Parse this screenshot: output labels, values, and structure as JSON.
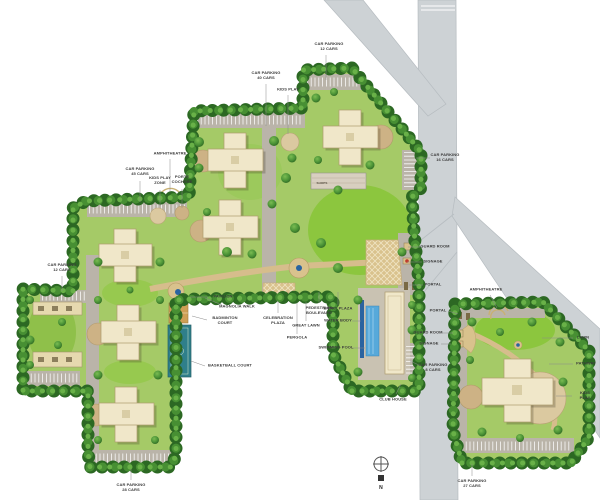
{
  "plan": {
    "title": "residential township master plan",
    "compass_north": "N",
    "labels": {
      "car_parking_12_top": "CAR PARKING\n12 CARS",
      "car_parking_40": "CAR PARKING\n40 CARS",
      "kids_play_top": "KIDS PLAY",
      "car_parking_16": "CAR PARKING\n16 CARS",
      "amphitheatre_left": "AMPHITHEATRE",
      "car_parking_45": "CAR PARKING\n45 CARS",
      "kids_play_zone": "KIDS PLAY\nZONE",
      "porte_cochere": "PORTE\nCOCHERE",
      "car_parking_12_left": "CAR PARKING\n12 CARS",
      "pavilion": "PAVILION",
      "magnolia_walk": "MAGNOLIA WALK",
      "badminton_court": "BADMINTON\nCOURT",
      "basketball_court": "BASKETBALL COURT",
      "celebration_plaza": "CELEBRATION\nPLAZA",
      "great_lawn": "GREAT LAWN",
      "pergola": "PERGOLA",
      "pedestrian_boulevard": "PEDESTRIAN\nBOULEVARD",
      "entry_plaza": "ENTRY PLAZA",
      "water_body": "WATER BODY",
      "swimming_pool": "SWIMMING POOL",
      "guard_room_main": "GUARD ROOM",
      "signage_main": "SIGNAGE",
      "portal_main": "PORTAL",
      "portal_east": "PORTAL",
      "guard_room_east": "GUARD ROOM",
      "signage_east": "SIGNAGE",
      "car_parking_8": "CAR PARKING\n8 CARS",
      "club_house": "CLUB HOUSE",
      "car_parking_28": "CAR PARKING\n28 CARS",
      "amphitheatre_right": "AMPHITHEATRE",
      "lawn_right": "LAWN",
      "pathway_right": "PATHWAY",
      "kids_play_right": "KIDS PLAY",
      "car_parking_27": "CAR PARKING\n27 CARS",
      "shops": "SHOPS"
    },
    "colors": {
      "road_gray": "#cdd2d5",
      "site_green": "#a5ca67",
      "lawn_green": "#8cc63e",
      "hedge_green": "#2c6823",
      "building_beige": "#f0e7c9",
      "walk_tan": "#d6bd8c",
      "plaza_khaki": "#d9c28d",
      "pool_blue": "#57a9da",
      "water_navy": "#2a63a0",
      "court_teal": "#2f7f8b"
    }
  }
}
